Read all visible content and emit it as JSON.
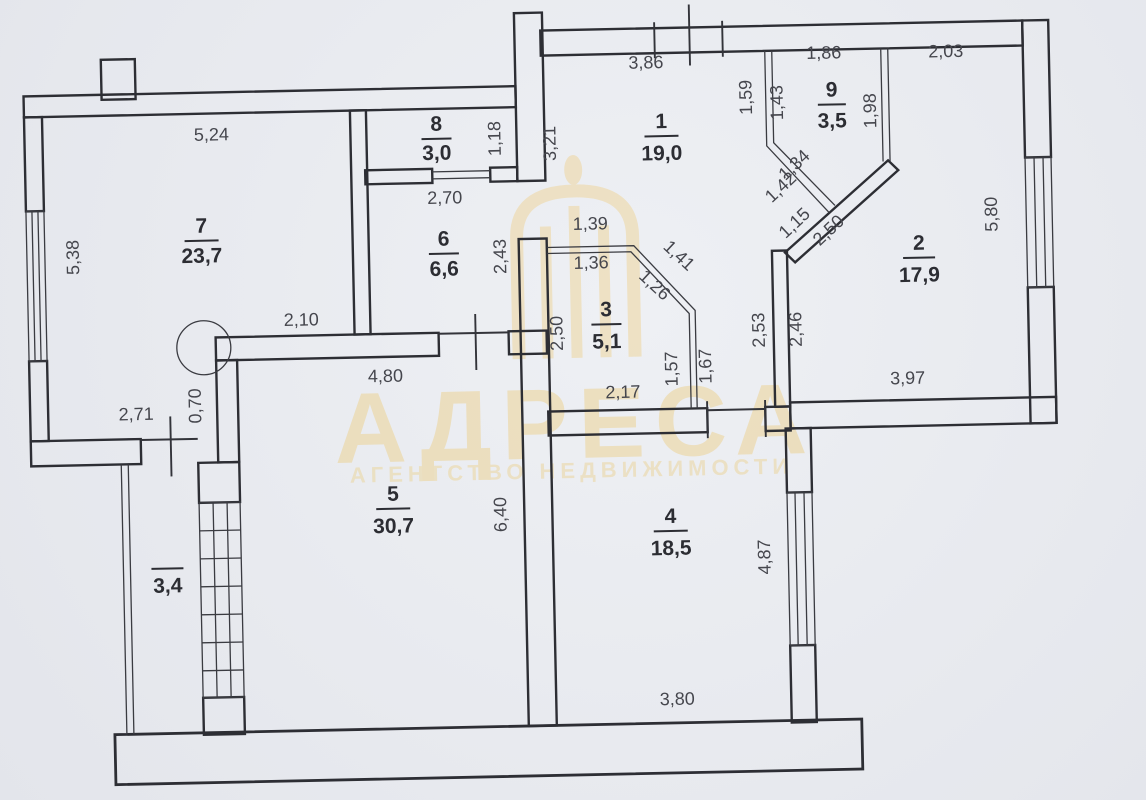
{
  "watermark": {
    "brand": "АДРЕСА",
    "subtitle": "АГЕНТСТВО НЕДВИЖИМОСТИ"
  },
  "colors": {
    "paper": "#e9ebef",
    "line": "#2d2e34",
    "dimension_text": "#45464d",
    "watermark": "#ecd6a0"
  },
  "rooms": {
    "r1": {
      "number": "1",
      "area": "19,0"
    },
    "r2": {
      "number": "2",
      "area": "17,9"
    },
    "r3": {
      "number": "3",
      "area": "5,1"
    },
    "r4": {
      "number": "4",
      "area": "18,5"
    },
    "r5": {
      "number": "5",
      "area": "30,7"
    },
    "r6": {
      "number": "6",
      "area": "6,6"
    },
    "r7": {
      "number": "7",
      "area": "23,7"
    },
    "r8": {
      "number": "8",
      "area": "3,0"
    },
    "r9": {
      "number": "9",
      "area": "3,5"
    },
    "balcony": {
      "area": "3,4"
    }
  },
  "dims": {
    "d5_24": "5,24",
    "d5_38": "5,38",
    "d2_71": "2,71",
    "d0_70": "0,70",
    "d2_10": "2,10",
    "d4_80": "4,80",
    "d1_18": "1,18",
    "d2_70": "2,70",
    "d2_43": "2,43",
    "d3_21": "3,21",
    "d3_86": "3,86",
    "d1_86": "1,86",
    "d2_03": "2,03",
    "d1_59": "1,59",
    "d1_43": "1,43",
    "d1_98": "1,98",
    "d1_34": "1,34",
    "d1_42": "1,42",
    "d1_15": "1,15",
    "d2_50_diag": "2,50",
    "d5_80": "5,80",
    "d1_39": "1,39",
    "d1_36": "1,36",
    "d1_41": "1,41",
    "d1_26": "1,26",
    "d2_50_hall": "2,50",
    "d1_57": "1,57",
    "d1_67": "1,67",
    "d2_17": "2,17",
    "d2_53": "2,53",
    "d2_46": "2,46",
    "d3_97": "3,97",
    "d6_40": "6,40",
    "d4_87": "4,87",
    "d3_80": "3,80"
  }
}
